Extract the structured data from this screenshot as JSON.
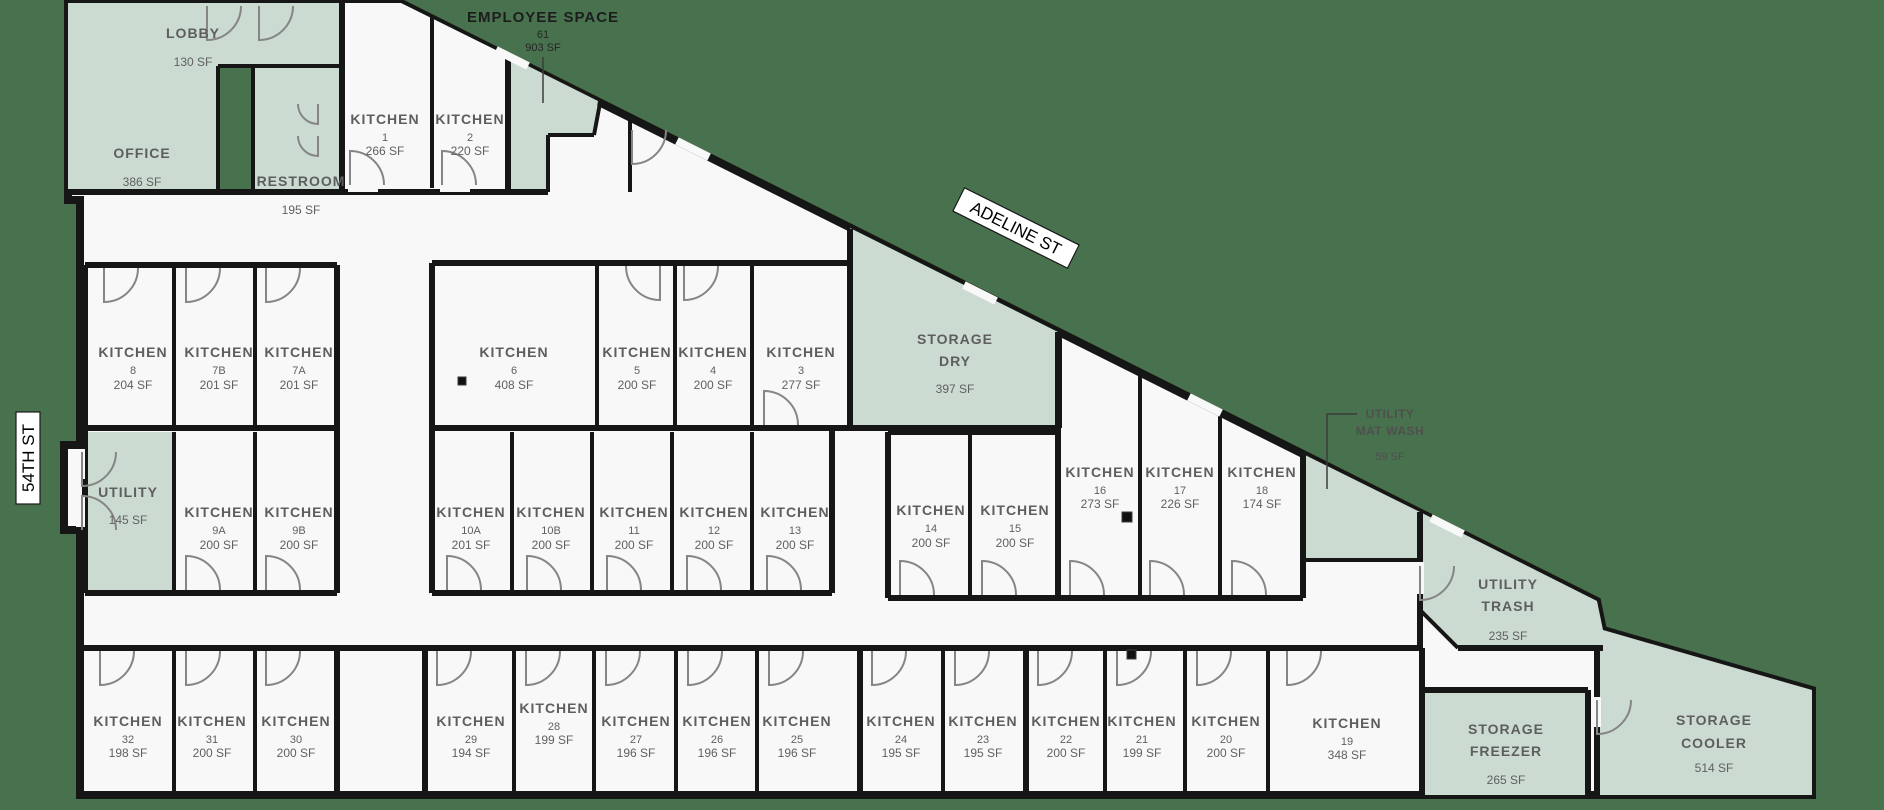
{
  "colors": {
    "background": "#47724d",
    "room_tint": "#cbdbd1",
    "room_white": "#f7f8f7",
    "wall": "#161616"
  },
  "streets": {
    "adeline": "ADELINE ST",
    "fifty_fourth": "54TH ST"
  },
  "rooms": {
    "office": {
      "name": "OFFICE",
      "area": "386 SF"
    },
    "lobby": {
      "name": "LOBBY",
      "area": "130 SF"
    },
    "restroom": {
      "name": "RESTROOM",
      "area": "195 SF"
    },
    "employee_space": {
      "name": "EMPLOYEE SPACE",
      "num": "61",
      "area": "903 SF"
    },
    "utility": {
      "name": "UTILITY",
      "area": "145 SF"
    },
    "storage_dry": {
      "line1": "STORAGE",
      "line2": "DRY",
      "area": "397 SF"
    },
    "utility_mat_wash": {
      "line1": "UTILITY",
      "line2": "MAT WASH",
      "area": "59 SF"
    },
    "utility_trash": {
      "line1": "UTILITY",
      "line2": "TRASH",
      "area": "235 SF"
    },
    "storage_freezer": {
      "line1": "STORAGE",
      "line2": "FREEZER",
      "area": "265 SF"
    },
    "storage_cooler": {
      "line1": "STORAGE",
      "line2": "COOLER",
      "area": "514 SF"
    },
    "k1": {
      "name": "KITCHEN",
      "num": "1",
      "area": "266 SF"
    },
    "k2": {
      "name": "KITCHEN",
      "num": "2",
      "area": "220 SF"
    },
    "k3": {
      "name": "KITCHEN",
      "num": "3",
      "area": "277 SF"
    },
    "k4": {
      "name": "KITCHEN",
      "num": "4",
      "area": "200 SF"
    },
    "k5": {
      "name": "KITCHEN",
      "num": "5",
      "area": "200 SF"
    },
    "k6": {
      "name": "KITCHEN",
      "num": "6",
      "area": "408 SF"
    },
    "k7a": {
      "name": "KITCHEN",
      "num": "7A",
      "area": "201 SF"
    },
    "k7b": {
      "name": "KITCHEN",
      "num": "7B",
      "area": "201 SF"
    },
    "k8": {
      "name": "KITCHEN",
      "num": "8",
      "area": "204 SF"
    },
    "k9a": {
      "name": "KITCHEN",
      "num": "9A",
      "area": "200 SF"
    },
    "k9b": {
      "name": "KITCHEN",
      "num": "9B",
      "area": "200 SF"
    },
    "k10a": {
      "name": "KITCHEN",
      "num": "10A",
      "area": "201 SF"
    },
    "k10b": {
      "name": "KITCHEN",
      "num": "10B",
      "area": "200 SF"
    },
    "k11": {
      "name": "KITCHEN",
      "num": "11",
      "area": "200 SF"
    },
    "k12": {
      "name": "KITCHEN",
      "num": "12",
      "area": "200 SF"
    },
    "k13": {
      "name": "KITCHEN",
      "num": "13",
      "area": "200 SF"
    },
    "k14": {
      "name": "KITCHEN",
      "num": "14",
      "area": "200 SF"
    },
    "k15": {
      "name": "KITCHEN",
      "num": "15",
      "area": "200 SF"
    },
    "k16": {
      "name": "KITCHEN",
      "num": "16",
      "area": "273 SF"
    },
    "k17": {
      "name": "KITCHEN",
      "num": "17",
      "area": "226 SF"
    },
    "k18": {
      "name": "KITCHEN",
      "num": "18",
      "area": "174 SF"
    },
    "k19": {
      "name": "KITCHEN",
      "num": "19",
      "area": "348 SF"
    },
    "k20": {
      "name": "KITCHEN",
      "num": "20",
      "area": "200 SF"
    },
    "k21": {
      "name": "KITCHEN",
      "num": "21",
      "area": "199 SF"
    },
    "k22": {
      "name": "KITCHEN",
      "num": "22",
      "area": "200 SF"
    },
    "k23": {
      "name": "KITCHEN",
      "num": "23",
      "area": "195 SF"
    },
    "k24": {
      "name": "KITCHEN",
      "num": "24",
      "area": "195 SF"
    },
    "k25": {
      "name": "KITCHEN",
      "num": "25",
      "area": "196 SF"
    },
    "k26": {
      "name": "KITCHEN",
      "num": "26",
      "area": "196 SF"
    },
    "k27": {
      "name": "KITCHEN",
      "num": "27",
      "area": "196 SF"
    },
    "k28": {
      "name": "KITCHEN",
      "num": "28",
      "area": "199 SF"
    },
    "k29": {
      "name": "KITCHEN",
      "num": "29",
      "area": "194 SF"
    },
    "k30": {
      "name": "KITCHEN",
      "num": "30",
      "area": "200 SF"
    },
    "k31": {
      "name": "KITCHEN",
      "num": "31",
      "area": "200 SF"
    },
    "k32": {
      "name": "KITCHEN",
      "num": "32",
      "area": "198 SF"
    }
  }
}
